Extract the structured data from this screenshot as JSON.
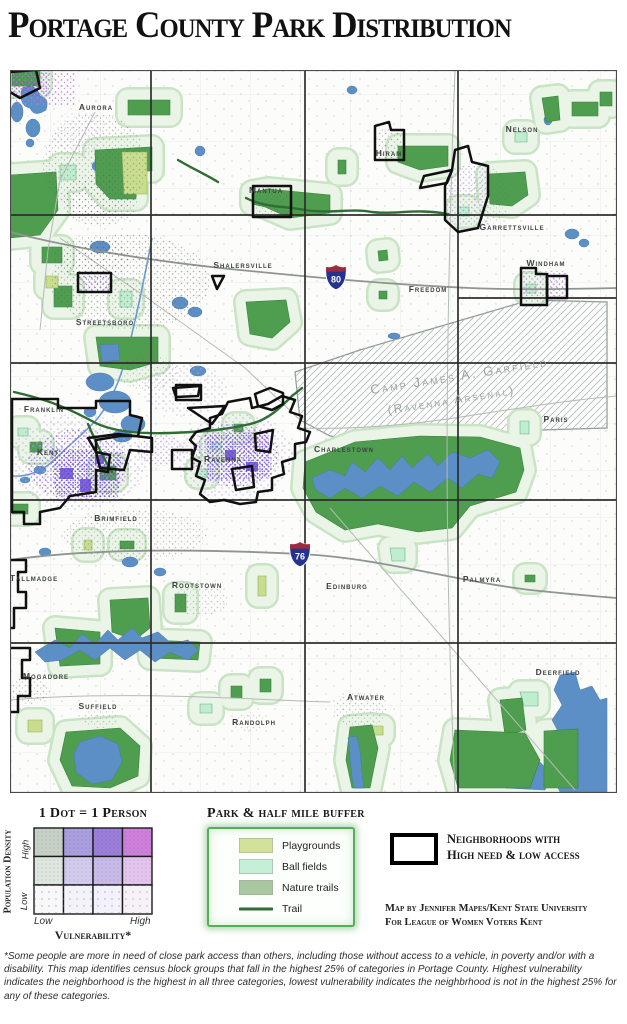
{
  "title": "Portage County Park Distribution",
  "map": {
    "townships": [
      "Aurora",
      "Mantua",
      "Hiram",
      "Nelson",
      "Garrettsville",
      "Shalersville",
      "Windham",
      "Freedom",
      "Streetsboro",
      "Franklin",
      "Kent",
      "Ravenna",
      "Charlestown",
      "Paris",
      "Brimfield",
      "Tallmadge",
      "Rootstown",
      "Edinburg",
      "Palmyra",
      "Mogadore",
      "Suffield",
      "Randolph",
      "Atwater",
      "Deerfield"
    ],
    "arsenal_line1": "Camp James A. Garfield",
    "arsenal_line2": "(Ravenna Arsenal)",
    "interstates": [
      "80",
      "76"
    ]
  },
  "legend_dots": {
    "title": "1 Dot = 1 Person",
    "y_axis_label": "Population Density",
    "y_high": "High",
    "y_low": "Low",
    "x_axis_label": "Vulnerability*",
    "x_low": "Low",
    "x_high": "High",
    "colors": [
      [
        "#c6d0c6",
        "#ab9ede",
        "#9b7ed7",
        "#cd80da"
      ],
      [
        "#dfe5df",
        "#d2cbee",
        "#c7bae9",
        "#e3c4ec"
      ],
      [
        "#f7f8f7",
        "#f4f3fa",
        "#f3f1f9",
        "#f7f1f8"
      ]
    ]
  },
  "legend_parks": {
    "title": "Park & half mile buffer",
    "items": [
      {
        "label": "Playgrounds",
        "color": "#d2e29a"
      },
      {
        "label": "Ball fields",
        "color": "#c5efd7"
      },
      {
        "label": "Nature trails",
        "color": "#a9c7a1"
      }
    ],
    "trail_label": "Trail",
    "trail_color": "#2f6d35"
  },
  "legend_neighborhoods": {
    "line1": "Neighborhoods with",
    "line2": "High need & low access"
  },
  "credit": {
    "line1": "Map by Jennifer Mapes/Kent State University",
    "line2": "For League of Women Voters Kent"
  },
  "footnote": "*Some people are more in need of close park access than others, including those without access to a vehicle, in poverty and/or with a disability. This map identifies census block groups that fall in the highest 25% of categories in Portage County. Highest vulnerability indicates the neighborhood is the highest in all three categories, lowest vulnerability indicates the neighbrhood is not in the highest 25% for any of these categories.",
  "colors": {
    "park_green": "#4f9e50",
    "buffer_green": "#eaf4e7",
    "water_blue": "#5d8fc7",
    "trail_green": "#2f6d35",
    "highlight_outline": "#000000"
  }
}
